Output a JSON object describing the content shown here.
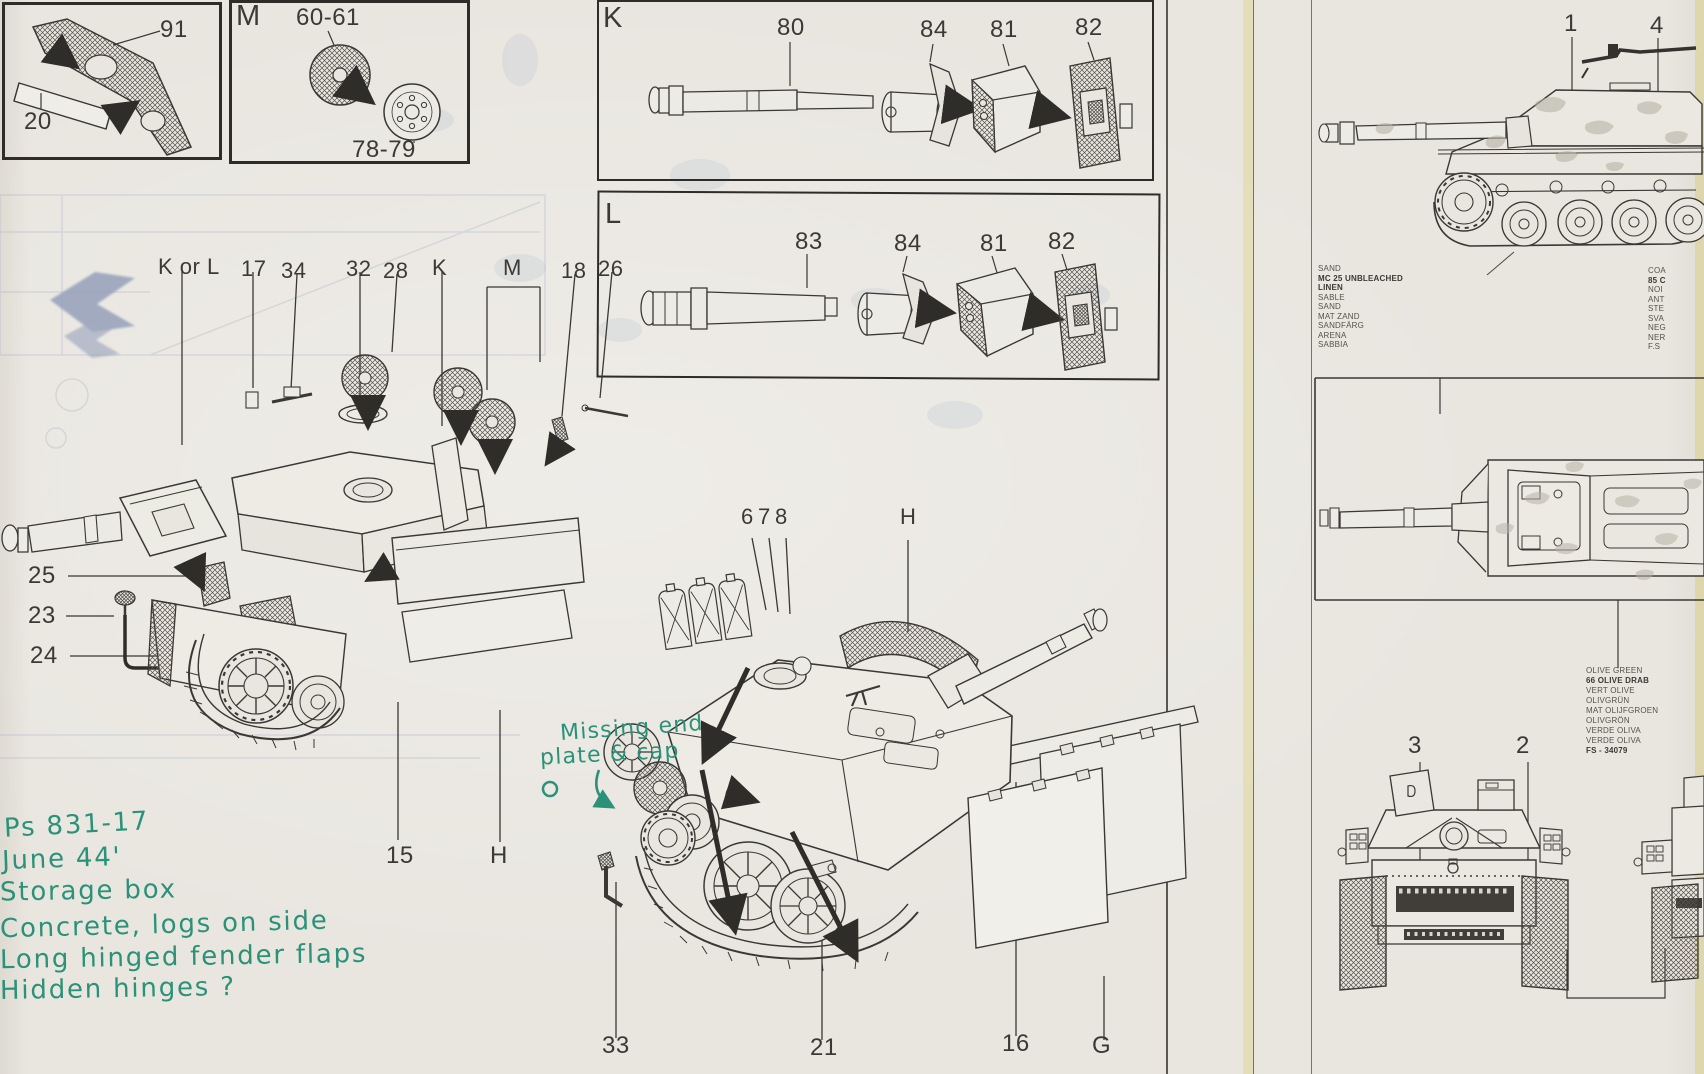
{
  "page": {
    "paper_color": "#e9e6e0",
    "ink_color": "#34322f",
    "annotation_color": "#2b9279",
    "ghost_print_color": "#8fa3c4"
  },
  "inset_fender": {
    "label_top": "91",
    "label_bottom": "20"
  },
  "inset_wheels": {
    "letter": "M",
    "label_top": "60-61",
    "label_bottom": "78-79"
  },
  "box_k": {
    "letter": "K",
    "labels": [
      "80",
      "84",
      "81",
      "82"
    ]
  },
  "box_l": {
    "letter": "L",
    "labels": [
      "83",
      "84",
      "81",
      "82"
    ]
  },
  "upper_assembly": {
    "top_labels": [
      "K or L",
      "17",
      "34",
      "32",
      "28",
      "K",
      "M",
      "18",
      "26"
    ],
    "left_labels": [
      "25",
      "23",
      "24"
    ],
    "bottom_labels": [
      "15",
      "H"
    ]
  },
  "lower_assembly": {
    "top_labels": [
      "6",
      "7",
      "8",
      "H"
    ],
    "bottom_labels": [
      "33",
      "21",
      "16",
      "G"
    ]
  },
  "right_panel": {
    "side_view_labels": [
      "1",
      "4"
    ],
    "front_view_labels": [
      "3",
      "2"
    ],
    "sand_colors": [
      "SAND",
      "MC 25 UNBLEACHED",
      "LINEN",
      "SABLE",
      "SAND",
      "MAT ZAND",
      "SANDFÄRG",
      "ARENA",
      "SABBIA"
    ],
    "edge_colors": [
      "COA",
      "85 C",
      "NOI",
      "ANT",
      "STE",
      "SVA",
      "NEG",
      "NER",
      "F.S"
    ],
    "olive_colors": [
      "OLIVE GREEN",
      "66 OLIVE DRAB",
      "VERT OLIVE",
      "OLIVGRÜN",
      "MAT OLIJFGROEN",
      "OLIVGRÖN",
      "VERDE OLIVA",
      "VERDE OLIVA",
      "FS - 34079"
    ]
  },
  "handwritten": {
    "missing_line1": "Missing end",
    "missing_line2": "plate & cap",
    "notes": [
      "Ps 831-17",
      "June 44'",
      "Storage box",
      "Concrete, logs on side",
      "Long hinged fender flaps",
      "Hidden hinges ?"
    ]
  }
}
